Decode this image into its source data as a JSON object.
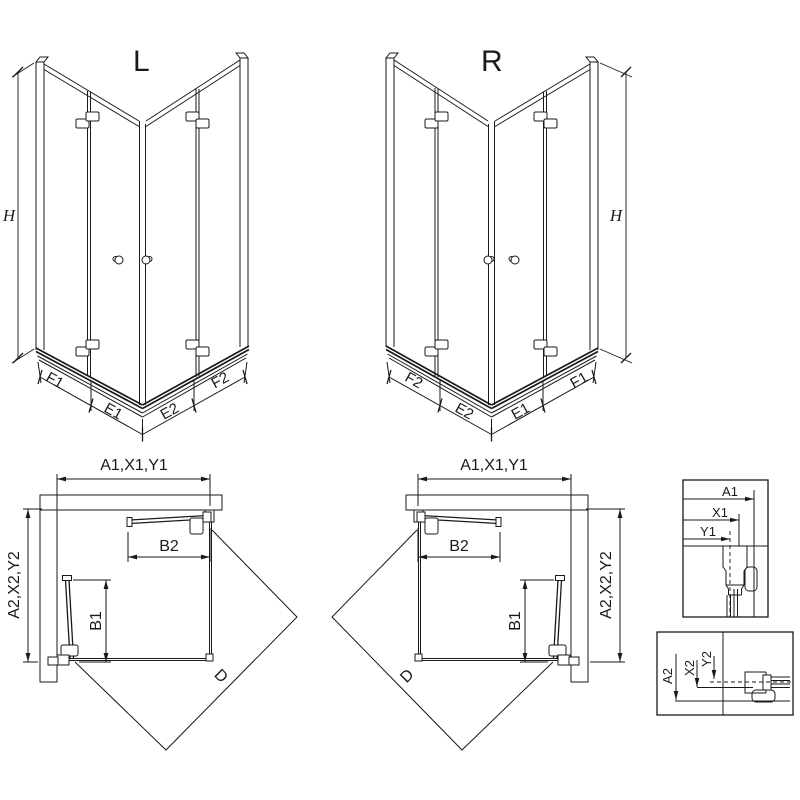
{
  "colors": {
    "background": "#ffffff",
    "line": "#1a1a1a"
  },
  "perspective_left": {
    "variant_label": "L",
    "height_dim": "H",
    "bottom_dims": [
      "F1",
      "E1",
      "E2",
      "F2"
    ]
  },
  "perspective_right": {
    "variant_label": "R",
    "height_dim": "H",
    "bottom_dims": [
      "F2",
      "E2",
      "E1",
      "F1"
    ]
  },
  "plan_left": {
    "width_dim": "A1,X1,Y1",
    "depth_dim": "A2,X2,Y2",
    "door_dim_top": "B2",
    "door_dim_side": "B1",
    "diagonal_dim": "D"
  },
  "plan_right": {
    "width_dim": "A1,X1,Y1",
    "depth_dim": "A2,X2,Y2",
    "door_dim_top": "B2",
    "door_dim_side": "B1",
    "diagonal_dim": "D"
  },
  "detail_top": {
    "dim_labels": [
      "A1",
      "X1",
      "Y1"
    ]
  },
  "detail_bottom": {
    "dim_labels": [
      "A2",
      "X2",
      "Y2"
    ]
  }
}
